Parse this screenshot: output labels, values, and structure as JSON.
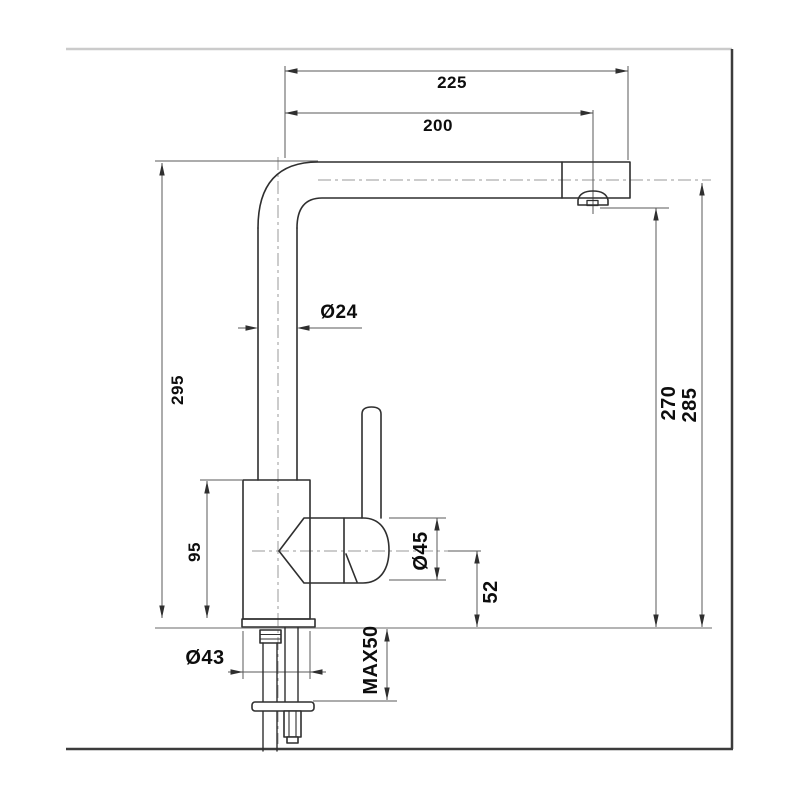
{
  "drawing": {
    "title": "faucet-dimension-drawing",
    "labels": {
      "d225": "225",
      "d200": "200",
      "d24": "Ø24",
      "d295": "295",
      "d95": "95",
      "d45": "Ø45",
      "d52": "52",
      "d270": "270",
      "d285": "285",
      "d43": "Ø43",
      "dmax50": "MAX50"
    },
    "colors": {
      "outline": "#2f2f2f",
      "dimension": "#5a5a5a",
      "centerline": "#9a9a9a",
      "counter_line": "#b4b4b4",
      "frame_top": "#cbcbcb",
      "frame_dark": "#3c3c3c",
      "label": "#0d0d0d",
      "background": "#ffffff"
    }
  }
}
